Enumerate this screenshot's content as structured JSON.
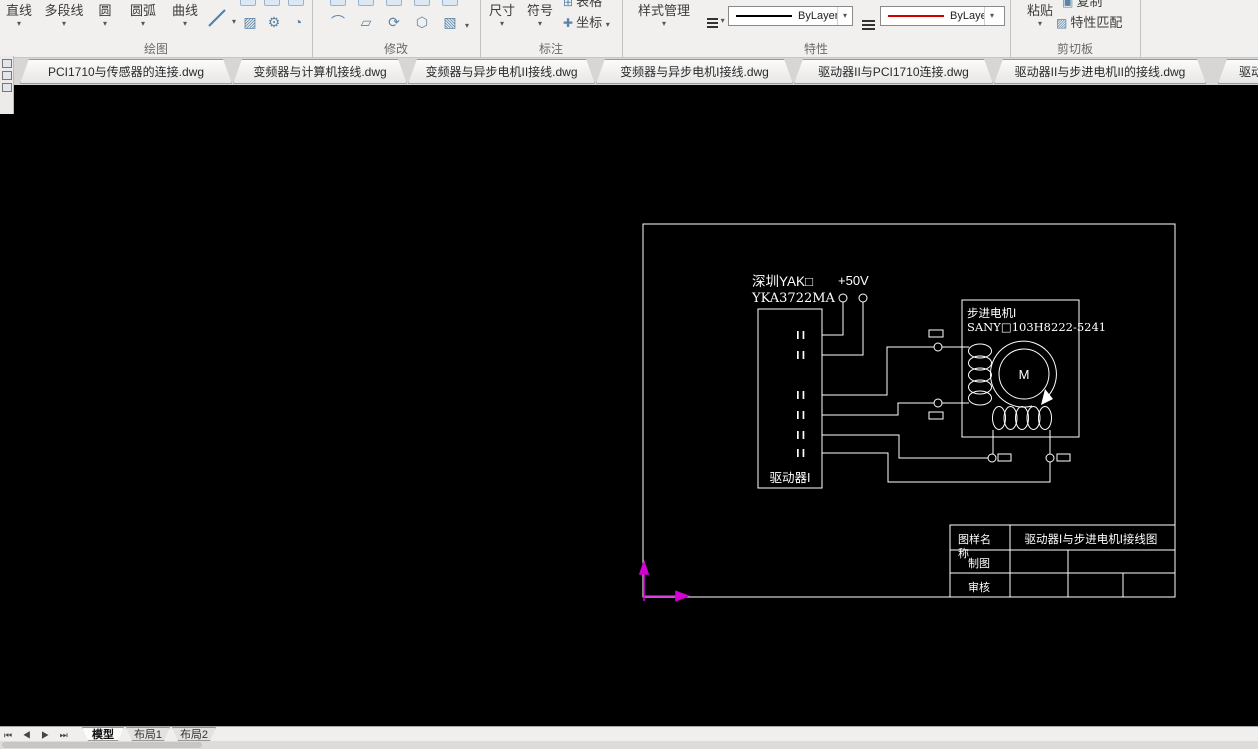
{
  "ribbon": {
    "draw": {
      "label": "绘图",
      "buttons": [
        {
          "label": "直线"
        },
        {
          "label": "多段线"
        },
        {
          "label": "圆"
        },
        {
          "label": "圆弧"
        },
        {
          "label": "曲线"
        }
      ]
    },
    "modify": {
      "label": "修改"
    },
    "annotate": {
      "label": "标注",
      "dimension": "尺寸",
      "symbol": "符号",
      "table": "表格",
      "coordinate": "坐标"
    },
    "properties": {
      "label": "特性",
      "style_manager": "样式管理",
      "linetype_value": "ByLayer",
      "color_value": "ByLayer",
      "linetype_color": "#000000",
      "color_swatch": "#d00000"
    },
    "clipboard": {
      "label": "剪切板",
      "paste": "粘贴",
      "copy": "复制",
      "match": "特性匹配"
    },
    "dropdown_glyph": "▾"
  },
  "file_tabs": [
    {
      "label": "PCI1710与传感器的连接.dwg"
    },
    {
      "label": "变频器与计算机接线.dwg"
    },
    {
      "label": "变频器与异步电机II接线.dwg"
    },
    {
      "label": "变频器与异步电机I接线.dwg"
    },
    {
      "label": "驱动器II与PCI1710连接.dwg"
    },
    {
      "label": "驱动器II与步进电机II的接线.dwg"
    },
    {
      "label": "驱动"
    }
  ],
  "drawing": {
    "vendor_line1": "深圳YAK□",
    "vendor_line2": "YKA3722MA",
    "voltage": "+50V",
    "motor_name": "步进电机I",
    "motor_model": "SANY□103H8222-5241",
    "driver_label": "驱动器I",
    "motor_symbol": "M",
    "line_color": "#ffffff",
    "ucs_color": "#d400d4",
    "title_block": {
      "name_field_line1": "图样名",
      "name_field_line2": "称",
      "drafter_field": "制图",
      "checker_field": "审核",
      "drawing_title": "驱动器I与步进电机I接线图"
    }
  },
  "sheet_tabs": {
    "model": "模型",
    "layout1": "布局1",
    "layout2": "布局2",
    "nav_glyphs": "⏮ ◀ ▶ ⏭"
  }
}
